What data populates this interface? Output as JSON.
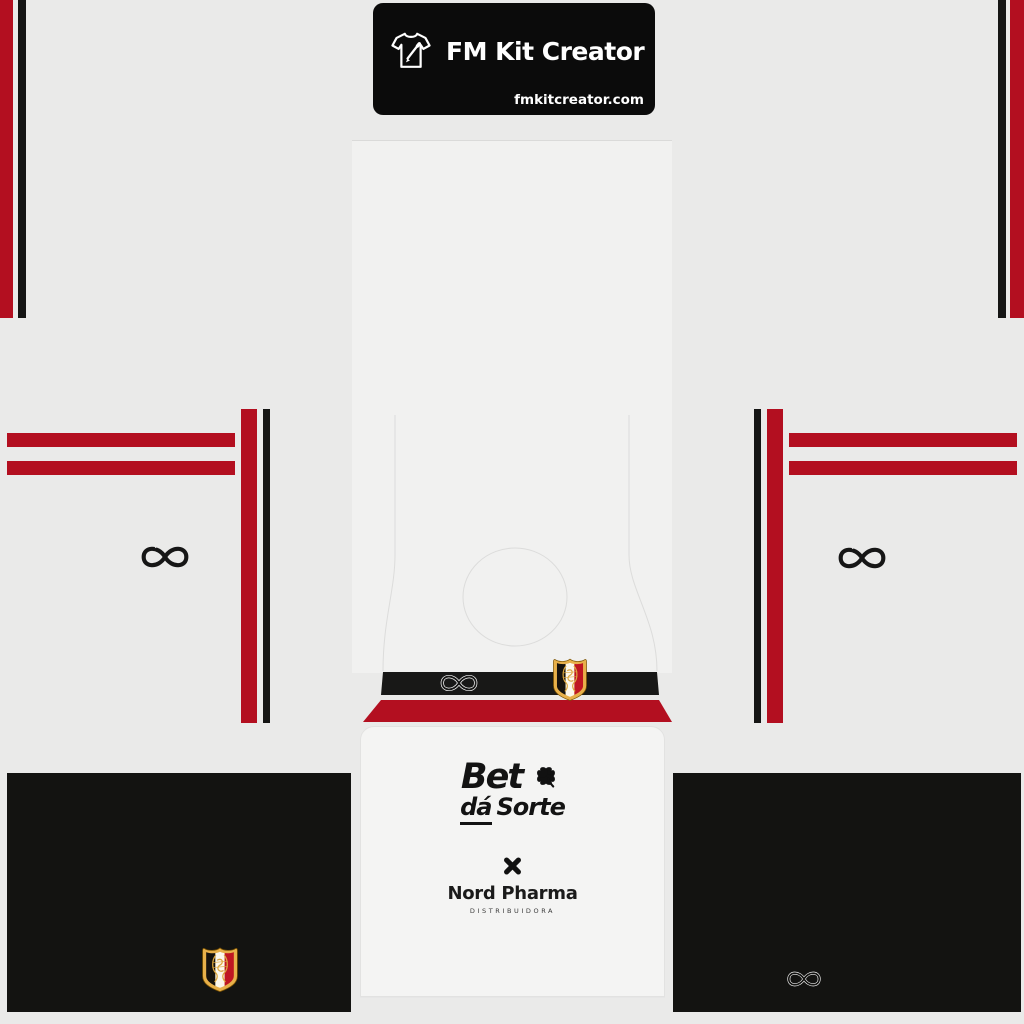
{
  "banner": {
    "title": "FM Kit Creator",
    "website": "fmkitcreator.com"
  },
  "sponsors": {
    "bet": {
      "word1": "Bet",
      "word2": "dá",
      "word3": "Sorte"
    },
    "nord": {
      "name": "Nord Pharma",
      "subtitle": "DISTRIBUIDORA"
    }
  },
  "icons": {
    "banner_icon": "tshirt-pencil-icon",
    "sleeve_logo": "infinity-logo",
    "chest_logo": "infinity-logo-outline",
    "shorts_logo": "infinity-logo-outline",
    "club_crest": "santa-cruz-crest",
    "bet_icon": "four-leaf-clover-icon",
    "nord_icon": "x-cross-icon"
  },
  "colors": {
    "red": "#b30f20",
    "black": "#151514",
    "panel": "#131311",
    "banner": "#0b0b0b",
    "bg": "#eaeae9",
    "gold": "#dca63e"
  }
}
